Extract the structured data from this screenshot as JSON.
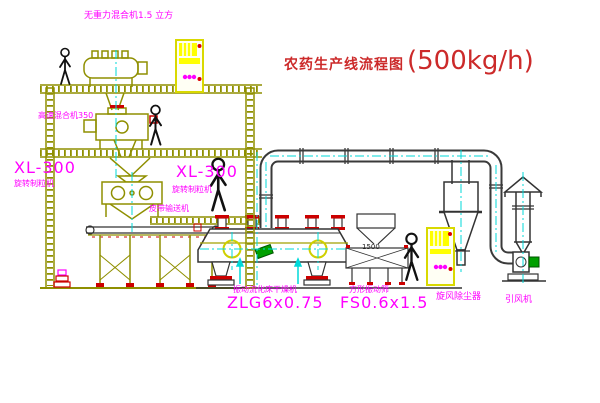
{
  "diagram": {
    "title": {
      "main": "农药生产线流程图",
      "capacity": "(500kg/h)"
    },
    "labels": {
      "gravity_mixer": "无重力混合机1.5 立方",
      "high_speed_mixer": "高速混合机350",
      "granulator_left_model": "XL-300",
      "granulator_left_name": "旋转制粒机",
      "granulator_center_model": "XL-300",
      "granulator_center_name": "旋转制粒机",
      "belt_conveyor": "皮带输送机",
      "dryer_name": "振动流化床干燥机",
      "dryer_model": "ZLG6x0.75",
      "sieve_name": "方形振动筛",
      "sieve_model": "FS0.6x1.5",
      "cyclone": "旋风除尘器",
      "fan": "引风机",
      "dim_1500": "1500"
    },
    "colors": {
      "structure": "#8f8f00",
      "cabinet_yellow": "#ffff00",
      "label_magenta": "#ff00ff",
      "title_red": "#cc2a2a",
      "accent_red": "#cc0000",
      "centerline_cyan": "#00d9d9",
      "line_dark": "#333333",
      "motor_green": "#00a000"
    }
  }
}
